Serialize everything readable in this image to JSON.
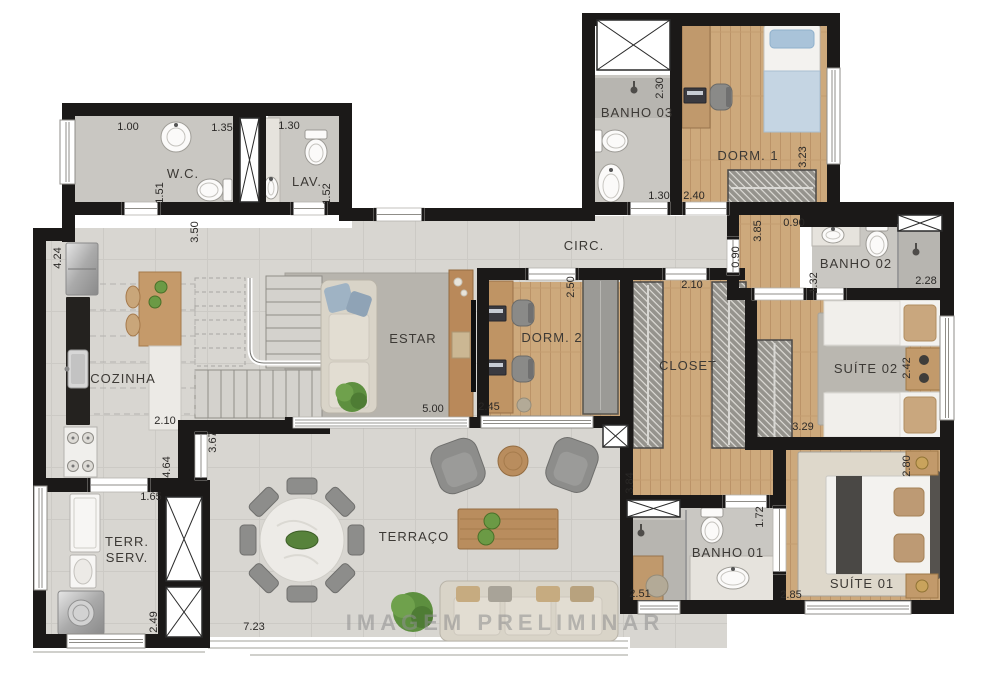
{
  "watermark": {
    "text": "IMAGEM PRELIMINAR",
    "x": 505,
    "y": 630
  },
  "colors": {
    "wall": "#1b1918",
    "tile_floor": "#d8d6d1",
    "wood_floor": "#cda97c",
    "bath_floor": "#c9c7c2",
    "shower_floor": "#b7b5b0",
    "estar_rug": "#b7b4ad",
    "suite_rug": "#ded8cb",
    "furniture_gray": "#8d8d8b",
    "sofa_beige": "#d9d4c8",
    "wood_furniture": "#b98d5e",
    "plant_green": "#5d8f3f",
    "label_text": "#3c3935",
    "dimension_text": "#2b2927",
    "watermark_gray": "#8f8f8f"
  },
  "rooms": [
    {
      "id": "wc",
      "label": "W.C.",
      "x": 183,
      "y": 178
    },
    {
      "id": "lav",
      "label": "LAV.",
      "x": 307,
      "y": 186
    },
    {
      "id": "banho-03",
      "label": "BANHO 03",
      "x": 637,
      "y": 117
    },
    {
      "id": "dorm-1",
      "label": "DORM. 1",
      "x": 748,
      "y": 160
    },
    {
      "id": "circ",
      "label": "CIRC.",
      "x": 584,
      "y": 250
    },
    {
      "id": "banho-02",
      "label": "BANHO 02",
      "x": 856,
      "y": 268
    },
    {
      "id": "suite-02",
      "label": "SUÍTE 02",
      "x": 866,
      "y": 373
    },
    {
      "id": "estar",
      "label": "ESTAR",
      "x": 413,
      "y": 343
    },
    {
      "id": "dorm-2",
      "label": "DORM. 2",
      "x": 552,
      "y": 342
    },
    {
      "id": "closet",
      "label": "CLOSET",
      "x": 688,
      "y": 370
    },
    {
      "id": "cozinha",
      "label": "COZINHA",
      "x": 123,
      "y": 383
    },
    {
      "id": "terraco",
      "label": "TERRAÇO",
      "x": 414,
      "y": 541
    },
    {
      "id": "terr-serv",
      "label": "TERR.\nSERV.",
      "x": 127,
      "y": 546
    },
    {
      "id": "banho-01",
      "label": "BANHO 01",
      "x": 728,
      "y": 557
    },
    {
      "id": "suite-01",
      "label": "SUÍTE 01",
      "x": 862,
      "y": 588
    }
  ],
  "dimensions": [
    {
      "value": "1.00",
      "x": 128,
      "y": 130,
      "rot": 0
    },
    {
      "value": "1.35",
      "x": 222,
      "y": 131,
      "rot": 0
    },
    {
      "value": "1.30",
      "x": 289,
      "y": 129,
      "rot": 0
    },
    {
      "value": "1.51",
      "x": 163,
      "y": 193,
      "rot": -90
    },
    {
      "value": "1.52",
      "x": 330,
      "y": 194,
      "rot": -90
    },
    {
      "value": "3.50",
      "x": 198,
      "y": 232,
      "rot": -90
    },
    {
      "value": "4.24",
      "x": 61,
      "y": 258,
      "rot": -90
    },
    {
      "value": "2.30",
      "x": 663,
      "y": 88,
      "rot": -90
    },
    {
      "value": "1.30",
      "x": 659,
      "y": 199,
      "rot": 0
    },
    {
      "value": "2.40",
      "x": 694,
      "y": 199,
      "rot": 0
    },
    {
      "value": "3.23",
      "x": 806,
      "y": 157,
      "rot": -90
    },
    {
      "value": "3.85",
      "x": 761,
      "y": 231,
      "rot": -90
    },
    {
      "value": "0.90",
      "x": 794,
      "y": 226,
      "rot": 0
    },
    {
      "value": "0.90",
      "x": 739,
      "y": 257,
      "rot": -90
    },
    {
      "value": "1.32",
      "x": 817,
      "y": 283,
      "rot": -90
    },
    {
      "value": "2.28",
      "x": 926,
      "y": 284,
      "rot": 0
    },
    {
      "value": "2.42",
      "x": 910,
      "y": 368,
      "rot": -90
    },
    {
      "value": "3.29",
      "x": 803,
      "y": 430,
      "rot": 0
    },
    {
      "value": "2.50",
      "x": 574,
      "y": 287,
      "rot": -90
    },
    {
      "value": "2.10",
      "x": 692,
      "y": 288,
      "rot": 0
    },
    {
      "value": "2.45",
      "x": 489,
      "y": 410,
      "rot": 0
    },
    {
      "value": "5.00",
      "x": 433,
      "y": 412,
      "rot": 0
    },
    {
      "value": "2.10",
      "x": 165,
      "y": 424,
      "rot": 0
    },
    {
      "value": "3.67",
      "x": 216,
      "y": 442,
      "rot": -90
    },
    {
      "value": "4.64",
      "x": 170,
      "y": 467,
      "rot": -90
    },
    {
      "value": "1.65",
      "x": 151,
      "y": 500,
      "rot": 0
    },
    {
      "value": "2.49",
      "x": 157,
      "y": 622,
      "rot": -90
    },
    {
      "value": "7.23",
      "x": 254,
      "y": 630,
      "rot": 0
    },
    {
      "value": "3.84",
      "x": 633,
      "y": 483,
      "rot": -90
    },
    {
      "value": "1.72",
      "x": 763,
      "y": 517,
      "rot": -90
    },
    {
      "value": "2.51",
      "x": 640,
      "y": 597,
      "rot": 0
    },
    {
      "value": "2.85",
      "x": 791,
      "y": 598,
      "rot": 0
    },
    {
      "value": "2.80",
      "x": 910,
      "y": 466,
      "rot": -90
    }
  ],
  "furniture": [
    {
      "type": "sink-round",
      "cx": 176,
      "cy": 137,
      "r": 15
    },
    {
      "type": "toilet",
      "cx": 211,
      "cy": 190,
      "dir": "W"
    },
    {
      "type": "counter-marble",
      "x": 263,
      "y": 118,
      "w": 17,
      "h": 87
    },
    {
      "type": "sink-oval",
      "cx": 271,
      "cy": 188,
      "rx": 7,
      "ry": 11
    },
    {
      "type": "toilet",
      "cx": 316,
      "cy": 152,
      "dir": "S"
    },
    {
      "type": "shower-head",
      "cx": 634,
      "cy": 90
    },
    {
      "type": "toilet",
      "cx": 614,
      "cy": 141,
      "dir": "E"
    },
    {
      "type": "sink-ped",
      "cx": 611,
      "cy": 183
    },
    {
      "type": "wardrobe-wood",
      "x": 682,
      "y": 25,
      "w": 28,
      "h": 103
    },
    {
      "type": "laptop",
      "x": 684,
      "y": 88,
      "w": 22,
      "h": 15
    },
    {
      "type": "office-chair",
      "x": 710,
      "y": 84
    },
    {
      "type": "bed-single-v",
      "x": 764,
      "y": 25,
      "w": 56,
      "h": 107
    },
    {
      "type": "wardrobe-hatch",
      "x": 728,
      "y": 170,
      "w": 88,
      "h": 36
    },
    {
      "type": "vanity",
      "x": 812,
      "y": 222,
      "w": 48,
      "h": 24
    },
    {
      "type": "sink-oval",
      "cx": 833,
      "cy": 235,
      "rx": 11,
      "ry": 8
    },
    {
      "type": "toilet",
      "cx": 877,
      "cy": 244,
      "dir": "S"
    },
    {
      "type": "shower-head",
      "cx": 916,
      "cy": 252
    },
    {
      "type": "rug",
      "x": 818,
      "y": 313,
      "w": 90,
      "h": 112
    },
    {
      "type": "bed-single-h",
      "x": 824,
      "y": 300,
      "w": 118,
      "h": 46
    },
    {
      "type": "bed-single-h",
      "x": 824,
      "y": 392,
      "w": 118,
      "h": 46
    },
    {
      "type": "nightstand",
      "x": 906,
      "y": 348,
      "w": 36,
      "h": 42,
      "lamps": true
    },
    {
      "type": "wardrobe-hatch",
      "x": 757,
      "y": 340,
      "w": 35,
      "h": 100
    },
    {
      "type": "wardrobe-hatch",
      "x": 633,
      "y": 282,
      "w": 30,
      "h": 166
    },
    {
      "type": "wardrobe-hatch",
      "x": 712,
      "y": 282,
      "w": 34,
      "h": 166
    },
    {
      "type": "bench-wood",
      "x": 633,
      "y": 556,
      "w": 30,
      "h": 48
    },
    {
      "type": "pouf",
      "cx": 657,
      "cy": 586,
      "r": 11
    },
    {
      "type": "desk-wood",
      "x": 481,
      "y": 281,
      "w": 32,
      "h": 132
    },
    {
      "type": "laptop",
      "x": 486,
      "y": 306,
      "w": 20,
      "h": 15
    },
    {
      "type": "laptop",
      "x": 486,
      "y": 360,
      "w": 20,
      "h": 15
    },
    {
      "type": "office-chair",
      "x": 512,
      "y": 300
    },
    {
      "type": "office-chair",
      "x": 512,
      "y": 356
    },
    {
      "type": "wardrobe-flat",
      "x": 583,
      "y": 277,
      "w": 35,
      "h": 137
    },
    {
      "type": "pouf",
      "cx": 524,
      "cy": 405,
      "r": 7
    },
    {
      "type": "tv-rack",
      "x": 449,
      "y": 270,
      "w": 24,
      "h": 147
    },
    {
      "type": "tv",
      "x": 471,
      "y": 300,
      "w": 5,
      "h": 92
    },
    {
      "type": "sofa-v",
      "x": 321,
      "y": 280,
      "w": 56,
      "h": 133
    },
    {
      "type": "plant",
      "cx": 352,
      "cy": 397,
      "r": 15
    },
    {
      "type": "fridge",
      "x": 66,
      "y": 243,
      "w": 32,
      "h": 52
    },
    {
      "type": "counter-dark",
      "x": 66,
      "y": 297,
      "w": 24,
      "h": 128
    },
    {
      "type": "sink-steel",
      "x": 68,
      "y": 350,
      "w": 20,
      "h": 38
    },
    {
      "type": "stove",
      "x": 64,
      "y": 427,
      "w": 33,
      "h": 50
    },
    {
      "type": "island-wood",
      "x": 139,
      "y": 272,
      "w": 42,
      "h": 74
    },
    {
      "type": "island-white",
      "x": 149,
      "y": 346,
      "w": 32,
      "h": 84
    },
    {
      "type": "stool",
      "x": 126,
      "y": 287
    },
    {
      "type": "stool",
      "x": 126,
      "y": 315
    },
    {
      "type": "plate",
      "cx": 161,
      "cy": 287,
      "r": 6
    },
    {
      "type": "plate",
      "cx": 155,
      "cy": 302,
      "r": 6
    },
    {
      "type": "dining-table",
      "cx": 302,
      "cy": 540,
      "r": 42
    },
    {
      "type": "chair-ring",
      "cx": 302,
      "cy": 540,
      "r": 54,
      "count": 8
    },
    {
      "type": "armchair",
      "x": 434,
      "y": 441,
      "w": 48,
      "h": 50,
      "rot": -20
    },
    {
      "type": "armchair",
      "x": 549,
      "y": 440,
      "w": 46,
      "h": 50,
      "rot": 20
    },
    {
      "type": "side-table",
      "cx": 513,
      "cy": 461,
      "r": 15
    },
    {
      "type": "coffee-table",
      "x": 458,
      "y": 509,
      "w": 100,
      "h": 40
    },
    {
      "type": "plate",
      "cx": 492,
      "cy": 521,
      "r": 8
    },
    {
      "type": "plate",
      "cx": 486,
      "cy": 537,
      "r": 8
    },
    {
      "type": "sofa-h",
      "x": 440,
      "y": 581,
      "w": 178,
      "h": 60
    },
    {
      "type": "plant",
      "cx": 413,
      "cy": 612,
      "r": 20
    },
    {
      "type": "tank",
      "x": 70,
      "y": 494,
      "w": 30,
      "h": 58
    },
    {
      "type": "sink-small",
      "x": 70,
      "y": 555,
      "w": 26,
      "h": 33
    },
    {
      "type": "washer",
      "x": 58,
      "y": 591,
      "w": 46,
      "h": 44
    },
    {
      "type": "shower-head",
      "cx": 641,
      "cy": 533
    },
    {
      "type": "toilet",
      "cx": 712,
      "cy": 530,
      "dir": "S"
    },
    {
      "type": "vanity",
      "x": 690,
      "y": 556,
      "w": 94,
      "h": 46
    },
    {
      "type": "sink-oval",
      "cx": 733,
      "cy": 578,
      "rx": 16,
      "ry": 11
    },
    {
      "type": "rug",
      "x": 798,
      "y": 452,
      "w": 140,
      "h": 144,
      "fill": "#ded8cb"
    },
    {
      "type": "bed-double",
      "x": 826,
      "y": 476,
      "w": 108,
      "h": 98
    },
    {
      "type": "nightstand",
      "x": 906,
      "y": 451,
      "w": 32,
      "h": 24,
      "gold": true
    },
    {
      "type": "nightstand",
      "x": 906,
      "y": 574,
      "w": 32,
      "h": 24,
      "gold": true
    }
  ]
}
